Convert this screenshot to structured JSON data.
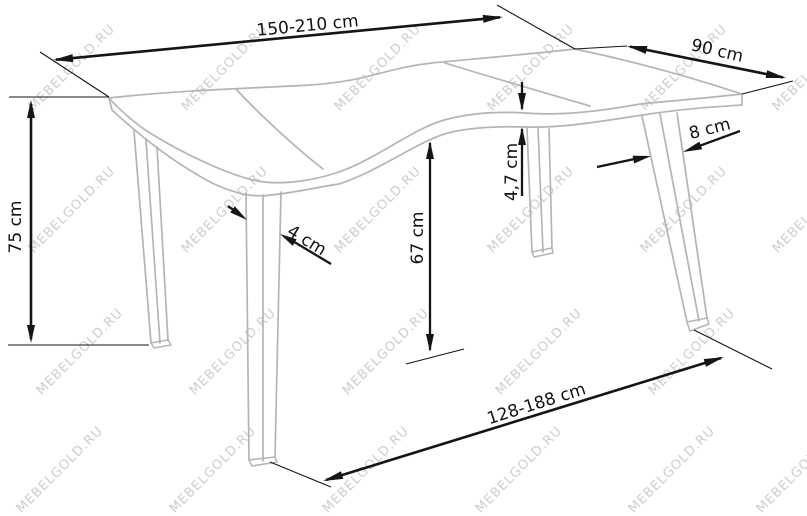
{
  "watermark": {
    "text": "MEBELGOLD.RU"
  },
  "diagram": {
    "type": "furniture-dimension-diagram",
    "subject": "extendable dining table, isometric line drawing",
    "dimensions": {
      "top_length": "150-210 cm",
      "top_depth": "90 cm",
      "height": "75 cm",
      "top_thickness": "4,7 cm",
      "underside_clearance": "67 cm",
      "leg_front_width": "4 cm",
      "leg_side_width": "8 cm",
      "base_span": "128-188 cm"
    },
    "line_colors": {
      "table_outline": "#b4b4b4",
      "dimension_lines": "#151515",
      "watermark": "#cdcdcd"
    }
  }
}
